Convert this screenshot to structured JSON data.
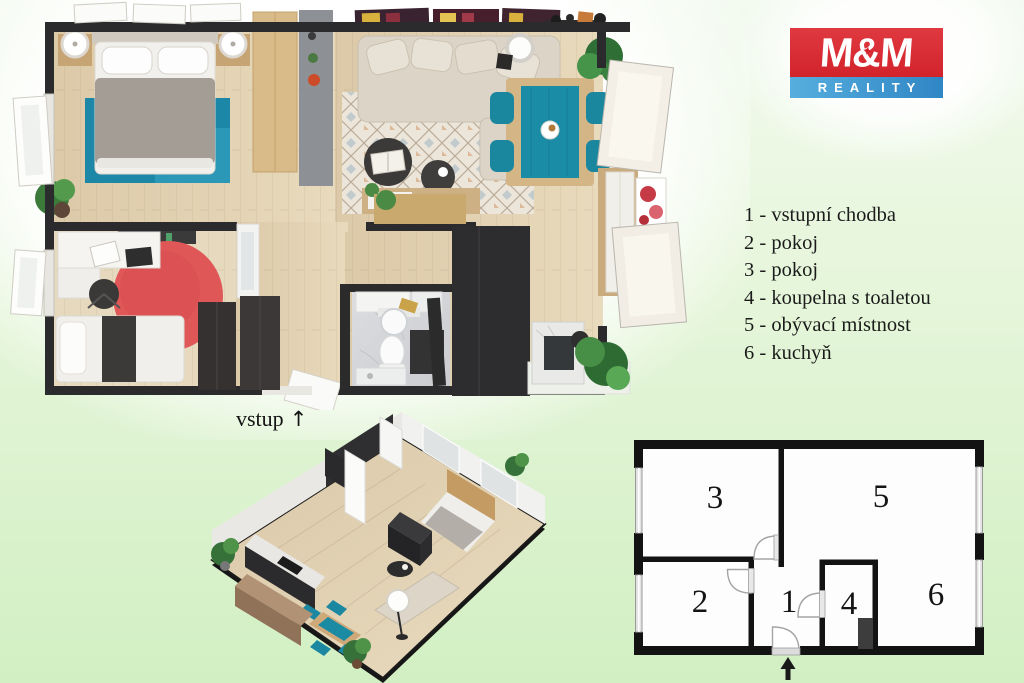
{
  "background": {
    "gradient_top": "#f3faef",
    "gradient_bottom": "#d2efc3"
  },
  "logo": {
    "title": "M&M",
    "subtitle": "REALITY",
    "star_glyph": "✦",
    "red": "#d2232b",
    "blue": "#2f86c4"
  },
  "legend": {
    "items": [
      "1 - vstupní chodba",
      "2 - pokoj",
      "3 - pokoj",
      "4 - koupelna s toaletou",
      "5 - obývací místnost",
      "6 - kuchyň"
    ]
  },
  "entrance": {
    "label": "vstup",
    "arrow_glyph": "↑"
  },
  "schematic": {
    "room_labels": [
      "1",
      "2",
      "3",
      "4",
      "5",
      "6"
    ]
  },
  "colors": {
    "accent_teal": "#1d87a8",
    "rug_red": "#e05758",
    "wall_dark": "#131313",
    "wood_floor": "#ddcaa9"
  }
}
